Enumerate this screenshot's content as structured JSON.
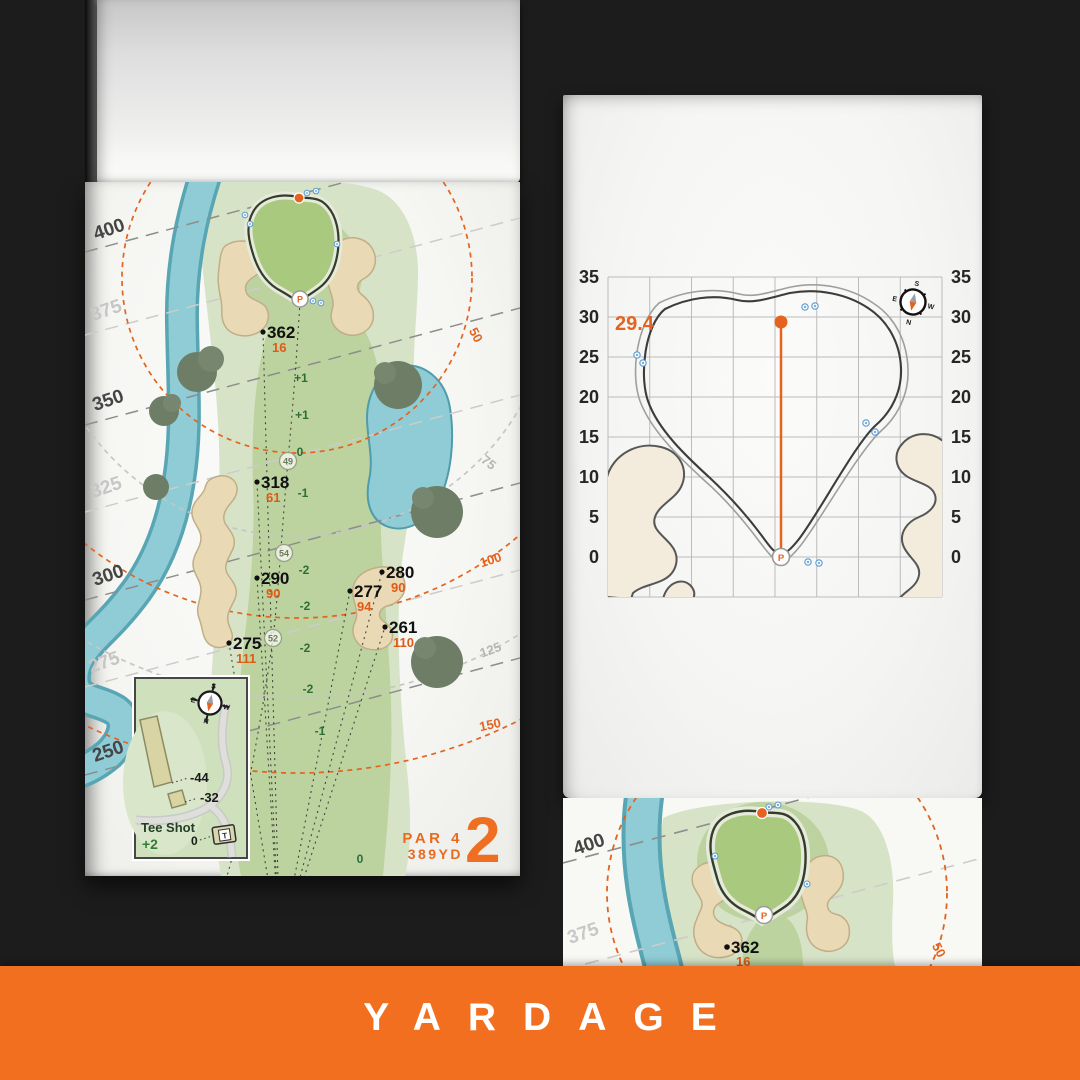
{
  "banner": {
    "label": "YARDAGE"
  },
  "pin_letter": "P",
  "compass": {
    "n": "N",
    "s": "S",
    "e": "E",
    "w": "W"
  },
  "left_page": {
    "hole": {
      "par": "PAR 4",
      "yardage": "389YD",
      "number": "2"
    },
    "distance_labels": [
      "400",
      "375",
      "350",
      "325",
      "300",
      "275",
      "250"
    ],
    "arc_labels": [
      "50",
      "75",
      "100",
      "125",
      "150"
    ],
    "markers": [
      {
        "distance": "362",
        "carry": "16"
      },
      {
        "distance": "318",
        "carry": "61"
      },
      {
        "distance": "290",
        "carry": "90"
      },
      {
        "distance": "275",
        "carry": "111"
      },
      {
        "distance": "277",
        "carry": "94"
      },
      {
        "distance": "280",
        "carry": "90"
      },
      {
        "distance": "261",
        "carry": "110"
      }
    ],
    "slope_labels": [
      "+1",
      "+1",
      "0",
      "-1",
      "-2",
      "-2",
      "-2",
      "-2",
      "-1",
      "0"
    ],
    "circled_labels": [
      "49",
      "54",
      "52"
    ],
    "tee_inset": {
      "title": "Tee Shot",
      "score": "+2",
      "zero": "0",
      "offset_a": "-44",
      "offset_b": "-32",
      "tee_letter": "T"
    }
  },
  "right_page": {
    "green_depth": "29.4",
    "axis_left": [
      "35",
      "30",
      "25",
      "20",
      "15",
      "10",
      "5",
      "0"
    ],
    "axis_right": [
      "35",
      "30",
      "25",
      "20",
      "15",
      "10",
      "5",
      "0"
    ]
  },
  "bottom_page": {
    "distance_labels": [
      "400",
      "375"
    ],
    "marker": {
      "distance": "362",
      "carry": "16"
    },
    "arc_label": "50"
  },
  "chart_data": {
    "type": "line",
    "title": "Green depth grid",
    "ylabel": "yards",
    "ylim": [
      0,
      35
    ],
    "yticks": [
      35,
      30,
      25,
      20,
      15,
      10,
      5,
      0
    ],
    "green_depth_yd": 29.4,
    "front_marker": "P",
    "grid": "on"
  },
  "colors": {
    "background": "#1C1C1C",
    "banner_orange": "#F26F1F",
    "map_orange": "#E4631F",
    "water": "#8FCCD6",
    "rough": "#D7E3C6",
    "fairway": "#BCD3A0",
    "green": "#A9C97E",
    "sand": "#EAD9B5",
    "page": "#F8F8F5"
  }
}
